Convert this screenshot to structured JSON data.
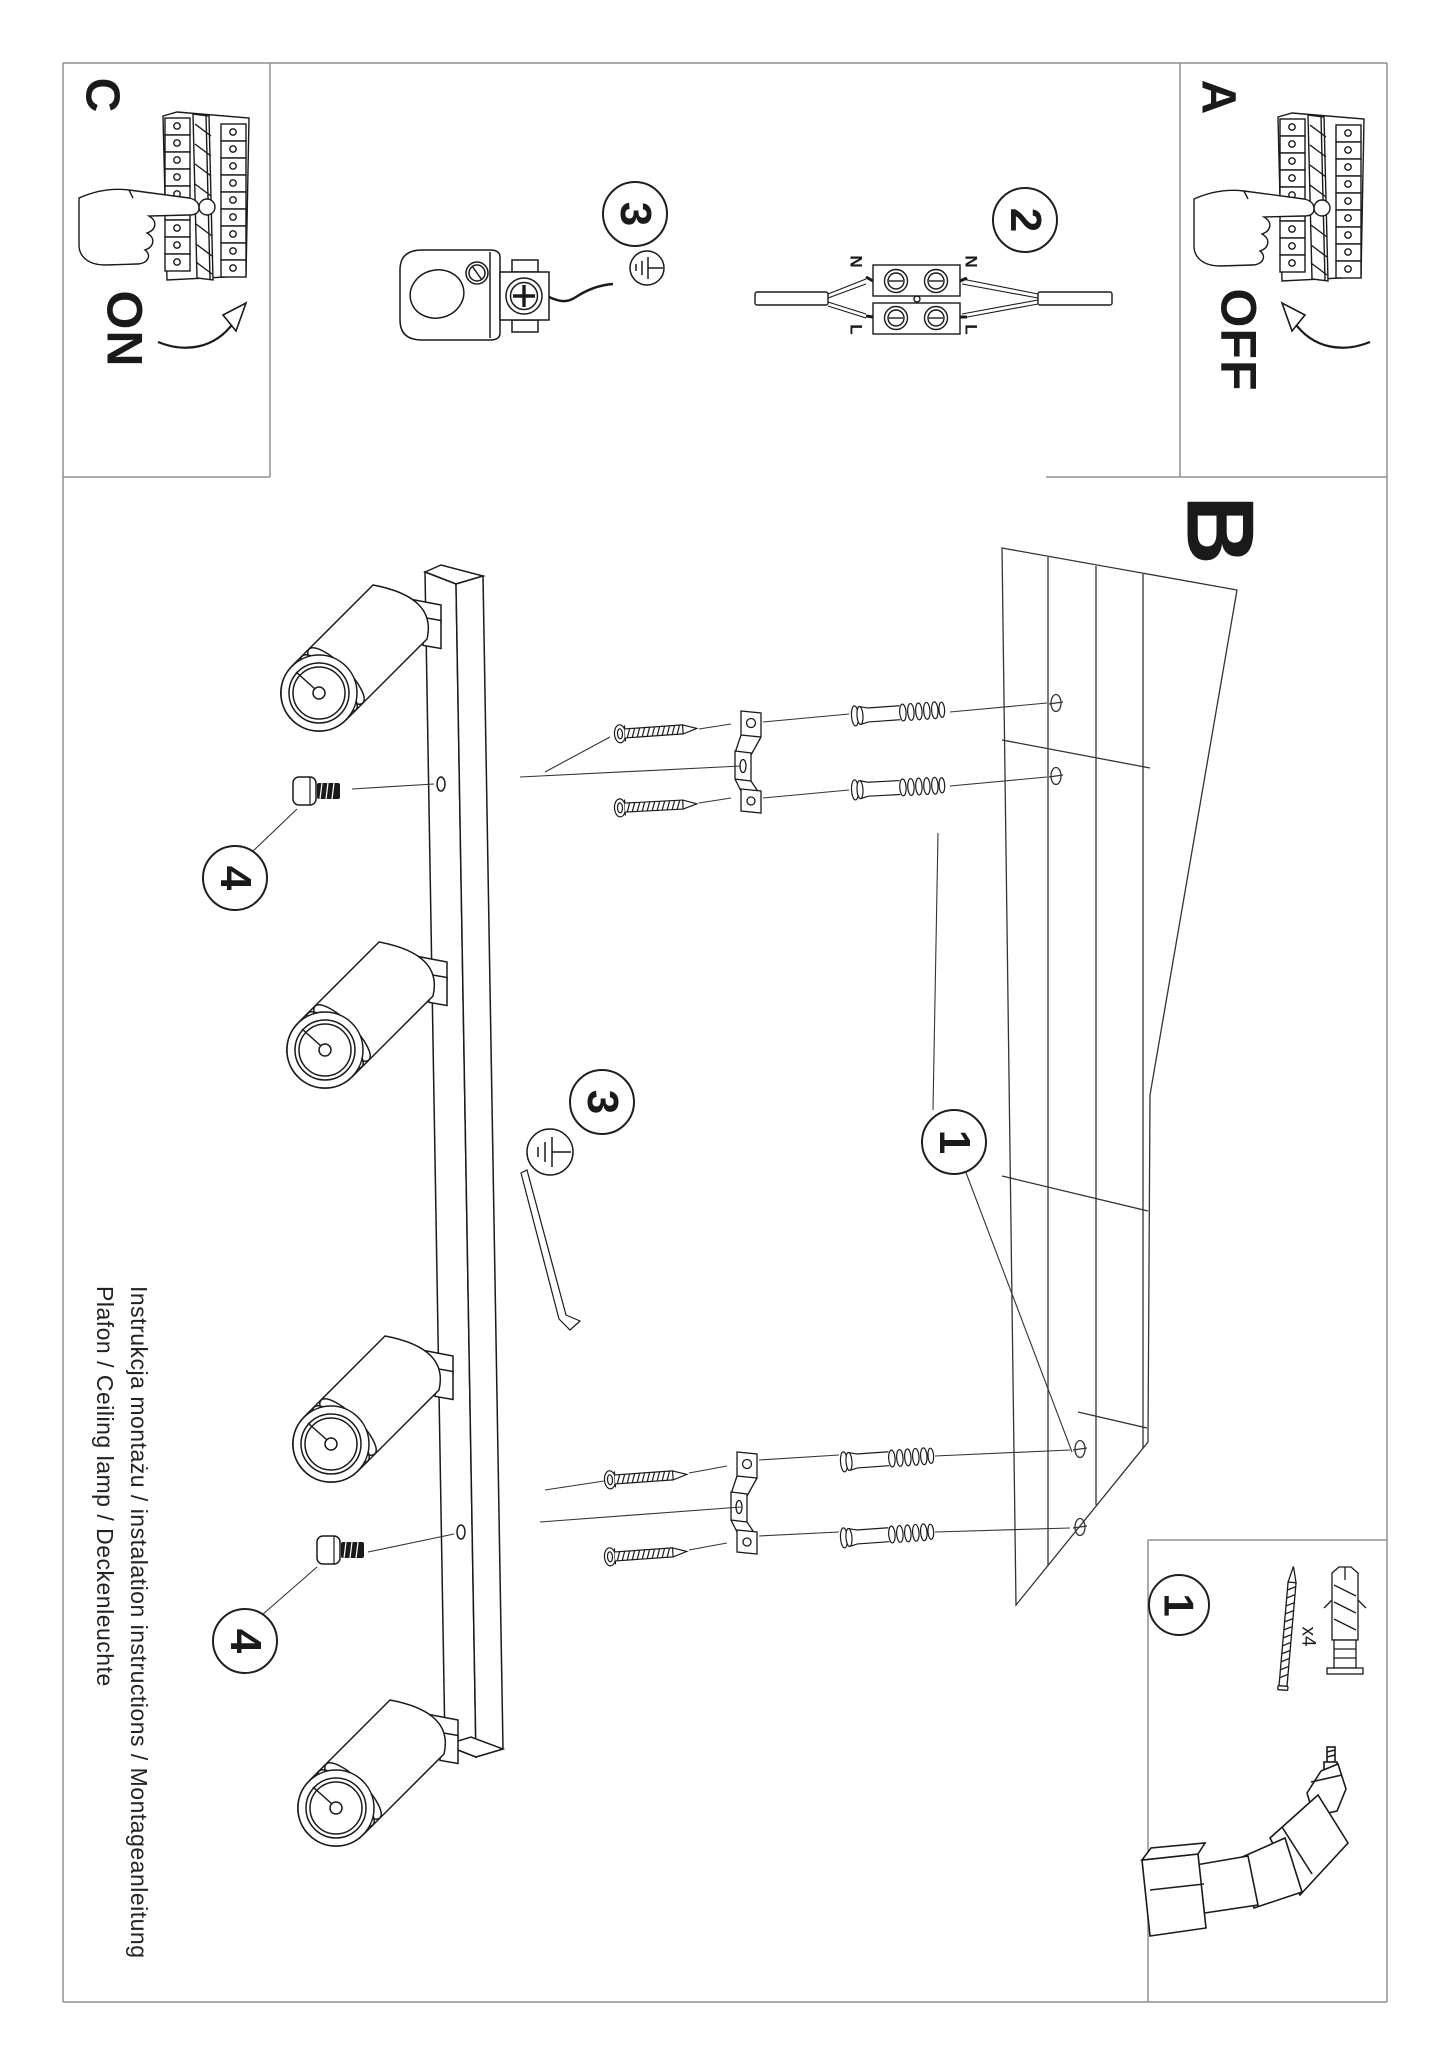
{
  "sections": {
    "a": {
      "label": "A",
      "switch_state": "OFF"
    },
    "b": {
      "label": "B"
    },
    "c": {
      "label": "C",
      "switch_state": "ON"
    }
  },
  "callouts": {
    "step1_assembly": "1",
    "step1_parts": "1",
    "step2_wiring": "2",
    "step3_canopy": "3",
    "step3_ground": "3",
    "step4_upper": "4",
    "step4_lower": "4"
  },
  "wiring_labels": {
    "neutral_left": "N",
    "neutral_right": "N",
    "live_left": "L",
    "live_right": "L"
  },
  "parts_box": {
    "screw_quantity": "x4"
  },
  "footer": {
    "line1": "Instrukcja montażu / instalation instructions / Montageanleitung",
    "line2": "Plafon / Ceiling lamp / Deckenleuchte"
  },
  "colors": {
    "ink": "#1a1a1a",
    "border": "#8f8f8f",
    "background": "#ffffff"
  }
}
